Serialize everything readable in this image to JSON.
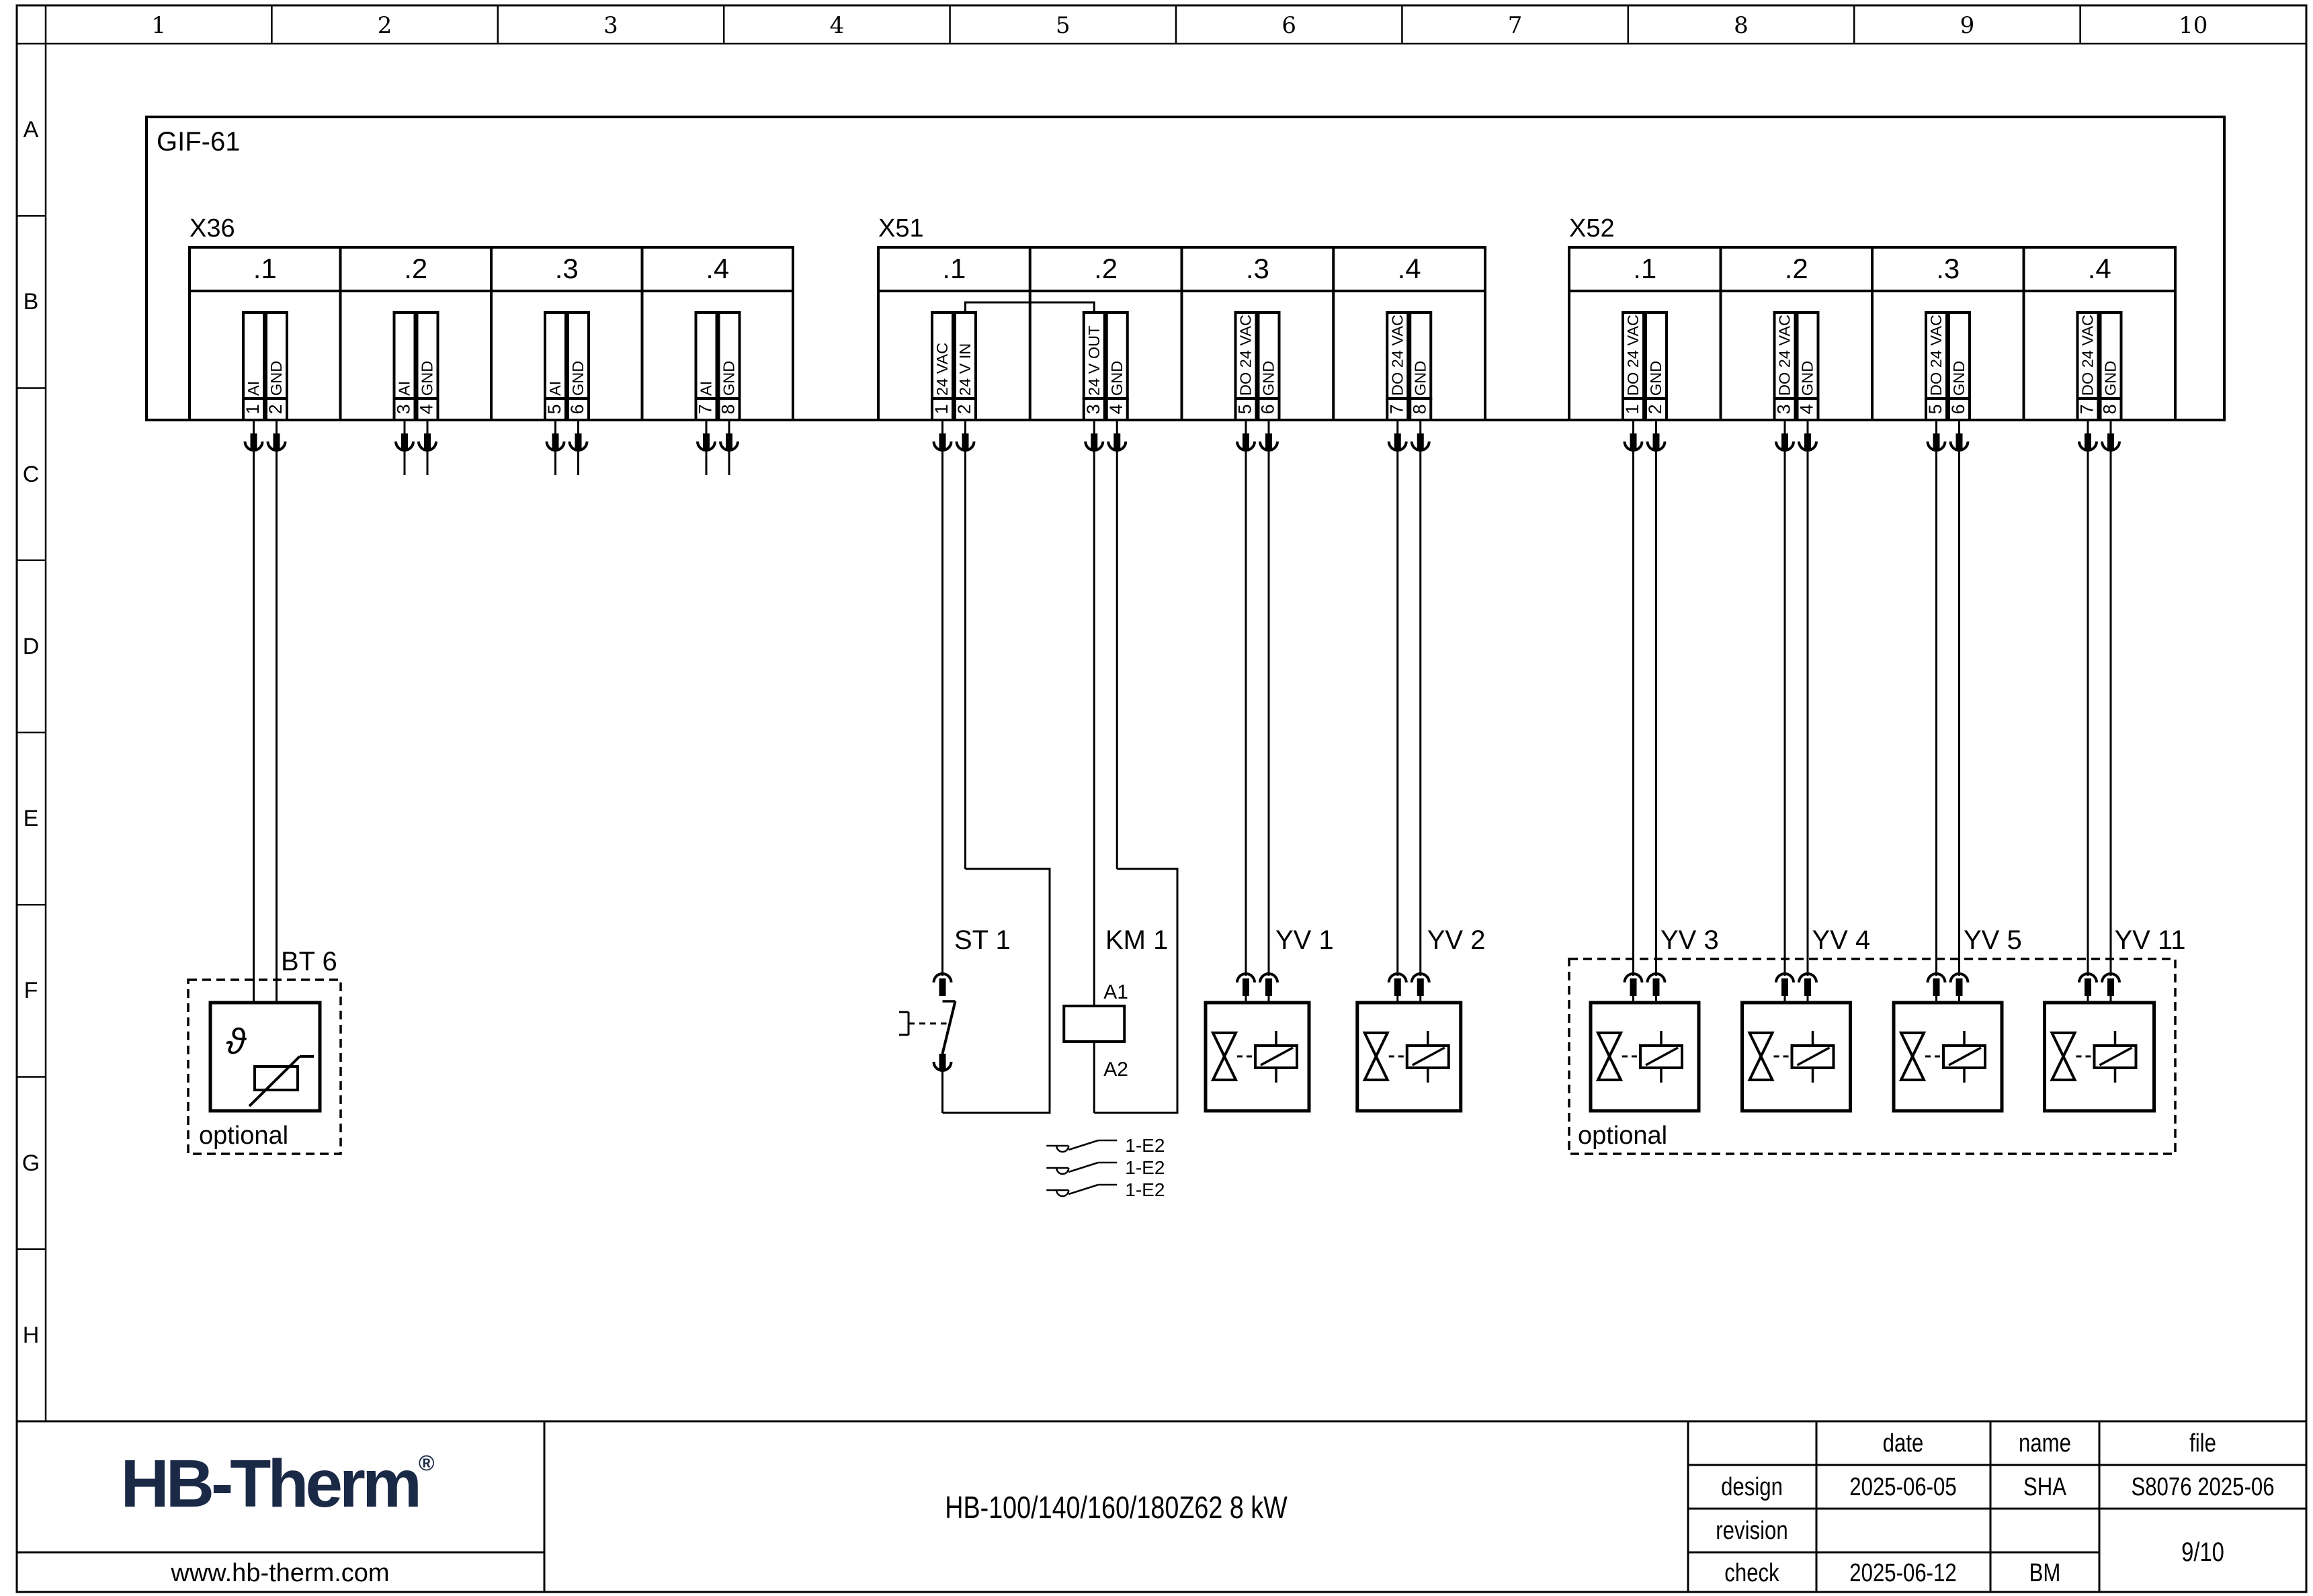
{
  "page": {
    "columns": [
      "1",
      "2",
      "3",
      "4",
      "5",
      "6",
      "7",
      "8",
      "9",
      "10"
    ],
    "rows": [
      "A",
      "B",
      "C",
      "D",
      "E",
      "F",
      "G",
      "H"
    ]
  },
  "module": {
    "label": "GIF-61"
  },
  "terminal_blocks": [
    {
      "name": "X36",
      "sections": [
        {
          "label": ".1",
          "pins": [
            {
              "no": "1",
              "signal": "AI"
            },
            {
              "no": "2",
              "signal": "GND"
            }
          ]
        },
        {
          "label": ".2",
          "pins": [
            {
              "no": "3",
              "signal": "AI"
            },
            {
              "no": "4",
              "signal": "GND"
            }
          ]
        },
        {
          "label": ".3",
          "pins": [
            {
              "no": "5",
              "signal": "AI"
            },
            {
              "no": "6",
              "signal": "GND"
            }
          ]
        },
        {
          "label": ".4",
          "pins": [
            {
              "no": "7",
              "signal": "AI"
            },
            {
              "no": "8",
              "signal": "GND"
            }
          ]
        }
      ]
    },
    {
      "name": "X51",
      "sections": [
        {
          "label": ".1",
          "pins": [
            {
              "no": "1",
              "signal": "24 VAC"
            },
            {
              "no": "2",
              "signal": "24 V IN"
            }
          ]
        },
        {
          "label": ".2",
          "pins": [
            {
              "no": "3",
              "signal": "24 V OUT"
            },
            {
              "no": "4",
              "signal": "GND"
            }
          ]
        },
        {
          "label": ".3",
          "pins": [
            {
              "no": "5",
              "signal": "DO 24 VAC"
            },
            {
              "no": "6",
              "signal": "GND"
            }
          ]
        },
        {
          "label": ".4",
          "pins": [
            {
              "no": "7",
              "signal": "DO 24 VAC"
            },
            {
              "no": "8",
              "signal": "GND"
            }
          ]
        }
      ]
    },
    {
      "name": "X52",
      "sections": [
        {
          "label": ".1",
          "pins": [
            {
              "no": "1",
              "signal": "DO 24 VAC"
            },
            {
              "no": "2",
              "signal": "GND"
            }
          ]
        },
        {
          "label": ".2",
          "pins": [
            {
              "no": "3",
              "signal": "DO 24 VAC"
            },
            {
              "no": "4",
              "signal": "GND"
            }
          ]
        },
        {
          "label": ".3",
          "pins": [
            {
              "no": "5",
              "signal": "DO 24 VAC"
            },
            {
              "no": "6",
              "signal": "GND"
            }
          ]
        },
        {
          "label": ".4",
          "pins": [
            {
              "no": "7",
              "signal": "DO 24 VAC"
            },
            {
              "no": "8",
              "signal": "GND"
            }
          ]
        }
      ]
    }
  ],
  "components": {
    "bt6": {
      "label": "BT 6",
      "symbol_text": "ϑ",
      "note": "optional"
    },
    "st1": {
      "label": "ST 1"
    },
    "km1": {
      "label": "KM 1",
      "coil_top": "A1",
      "coil_bottom": "A2",
      "contact_refs": [
        "1-E2",
        "1-E2",
        "1-E2"
      ]
    },
    "valves": [
      {
        "label": "YV 1"
      },
      {
        "label": "YV 2"
      },
      {
        "label": "YV 3"
      },
      {
        "label": "YV 4"
      },
      {
        "label": "YV 5"
      },
      {
        "label": "YV 11"
      }
    ],
    "optional_group_note": "optional"
  },
  "title_block": {
    "logo_text": "HB-Therm",
    "logo_mark": "®",
    "logo_color": "#1a2946",
    "website": "www.hb-therm.com",
    "document_title": "HB-100/140/160/180Z62 8 kW",
    "table": {
      "col_headers": [
        "date",
        "name",
        "file"
      ],
      "rows": [
        {
          "label": "design",
          "date": "2025-06-05",
          "name": "SHA",
          "file": "S8076 2025-06"
        },
        {
          "label": "revision",
          "date": "",
          "name": "",
          "file": ""
        },
        {
          "label": "check",
          "date": "2025-06-12",
          "name": "BM",
          "file": ""
        }
      ],
      "page_number": "9/10"
    }
  }
}
